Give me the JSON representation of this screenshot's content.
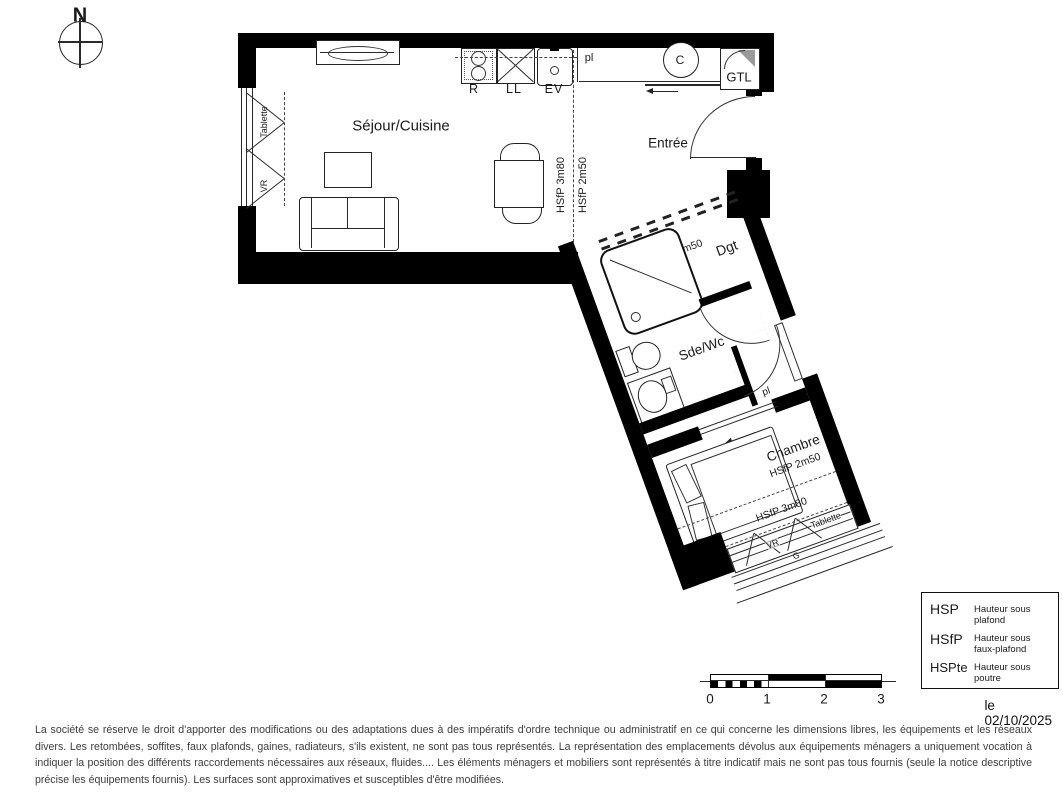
{
  "compass": {
    "north": "N"
  },
  "rooms": {
    "sejour": {
      "name": "Séjour/Cuisine"
    },
    "entree": {
      "name": "Entrée"
    },
    "dgt": {
      "name": "Dgt",
      "ceiling": "HSfP 2m50"
    },
    "sdewc": {
      "name": "Sde/Wc"
    },
    "chambre": {
      "name": "Chambre",
      "ceiling_a": "HSfP 2m50",
      "ceiling_b": "HSfP 3m80"
    }
  },
  "kitchen": {
    "fridge": "R",
    "washer": "LL",
    "sink": "EV"
  },
  "entree_items": {
    "closet": "pl",
    "column": "C",
    "gtl": "GTL"
  },
  "dgt_items": {
    "closet": "pl"
  },
  "sejour_window": {
    "shelf": "Tablette",
    "shutter": "VR"
  },
  "chambre_window": {
    "shutter": "VR",
    "shelf": "Tablette",
    "railing": "G"
  },
  "ceiling_lines": {
    "left": "HSfP 3m80",
    "right": "HSfP 2m50"
  },
  "legend": {
    "rows": [
      {
        "abbr": "HSP",
        "desc": "Hauteur sous plafond"
      },
      {
        "abbr": "HSfP",
        "desc": "Hauteur sous faux-plafond"
      },
      {
        "abbr": "HSPte",
        "desc": "Hauteur sous poutre"
      }
    ]
  },
  "date": "le 02/10/2025",
  "scale_bar": {
    "ticks": [
      "0",
      "1",
      "2",
      "3"
    ]
  },
  "disclaimer": "La société se réserve le droit d'apporter des modifications ou des adaptations dues à des impératifs d'ordre technique ou administratif en ce qui concerne les dimensions libres, les équipements et les réseaux divers. Les retombées, soffites, faux plafonds, gaines, radiateurs, s'ils existent, ne sont pas tous représentés. La représentation des emplacements dévolus aux équipements ménagers a uniquement vocation à indiquer la position des différents raccordements nécessaires aux réseaux, fluides.... Les éléments ménagers et mobiliers sont représentés à titre indicatif mais ne sont pas tous fournis (seule la notice descriptive précise les équipements fournis). Les surfaces sont approximatives et susceptibles d'être modifiées.",
  "colors": {
    "wall": "#000000",
    "line": "#2a2a2a",
    "text": "#1a1a1a",
    "muted": "#3c3c3c"
  }
}
